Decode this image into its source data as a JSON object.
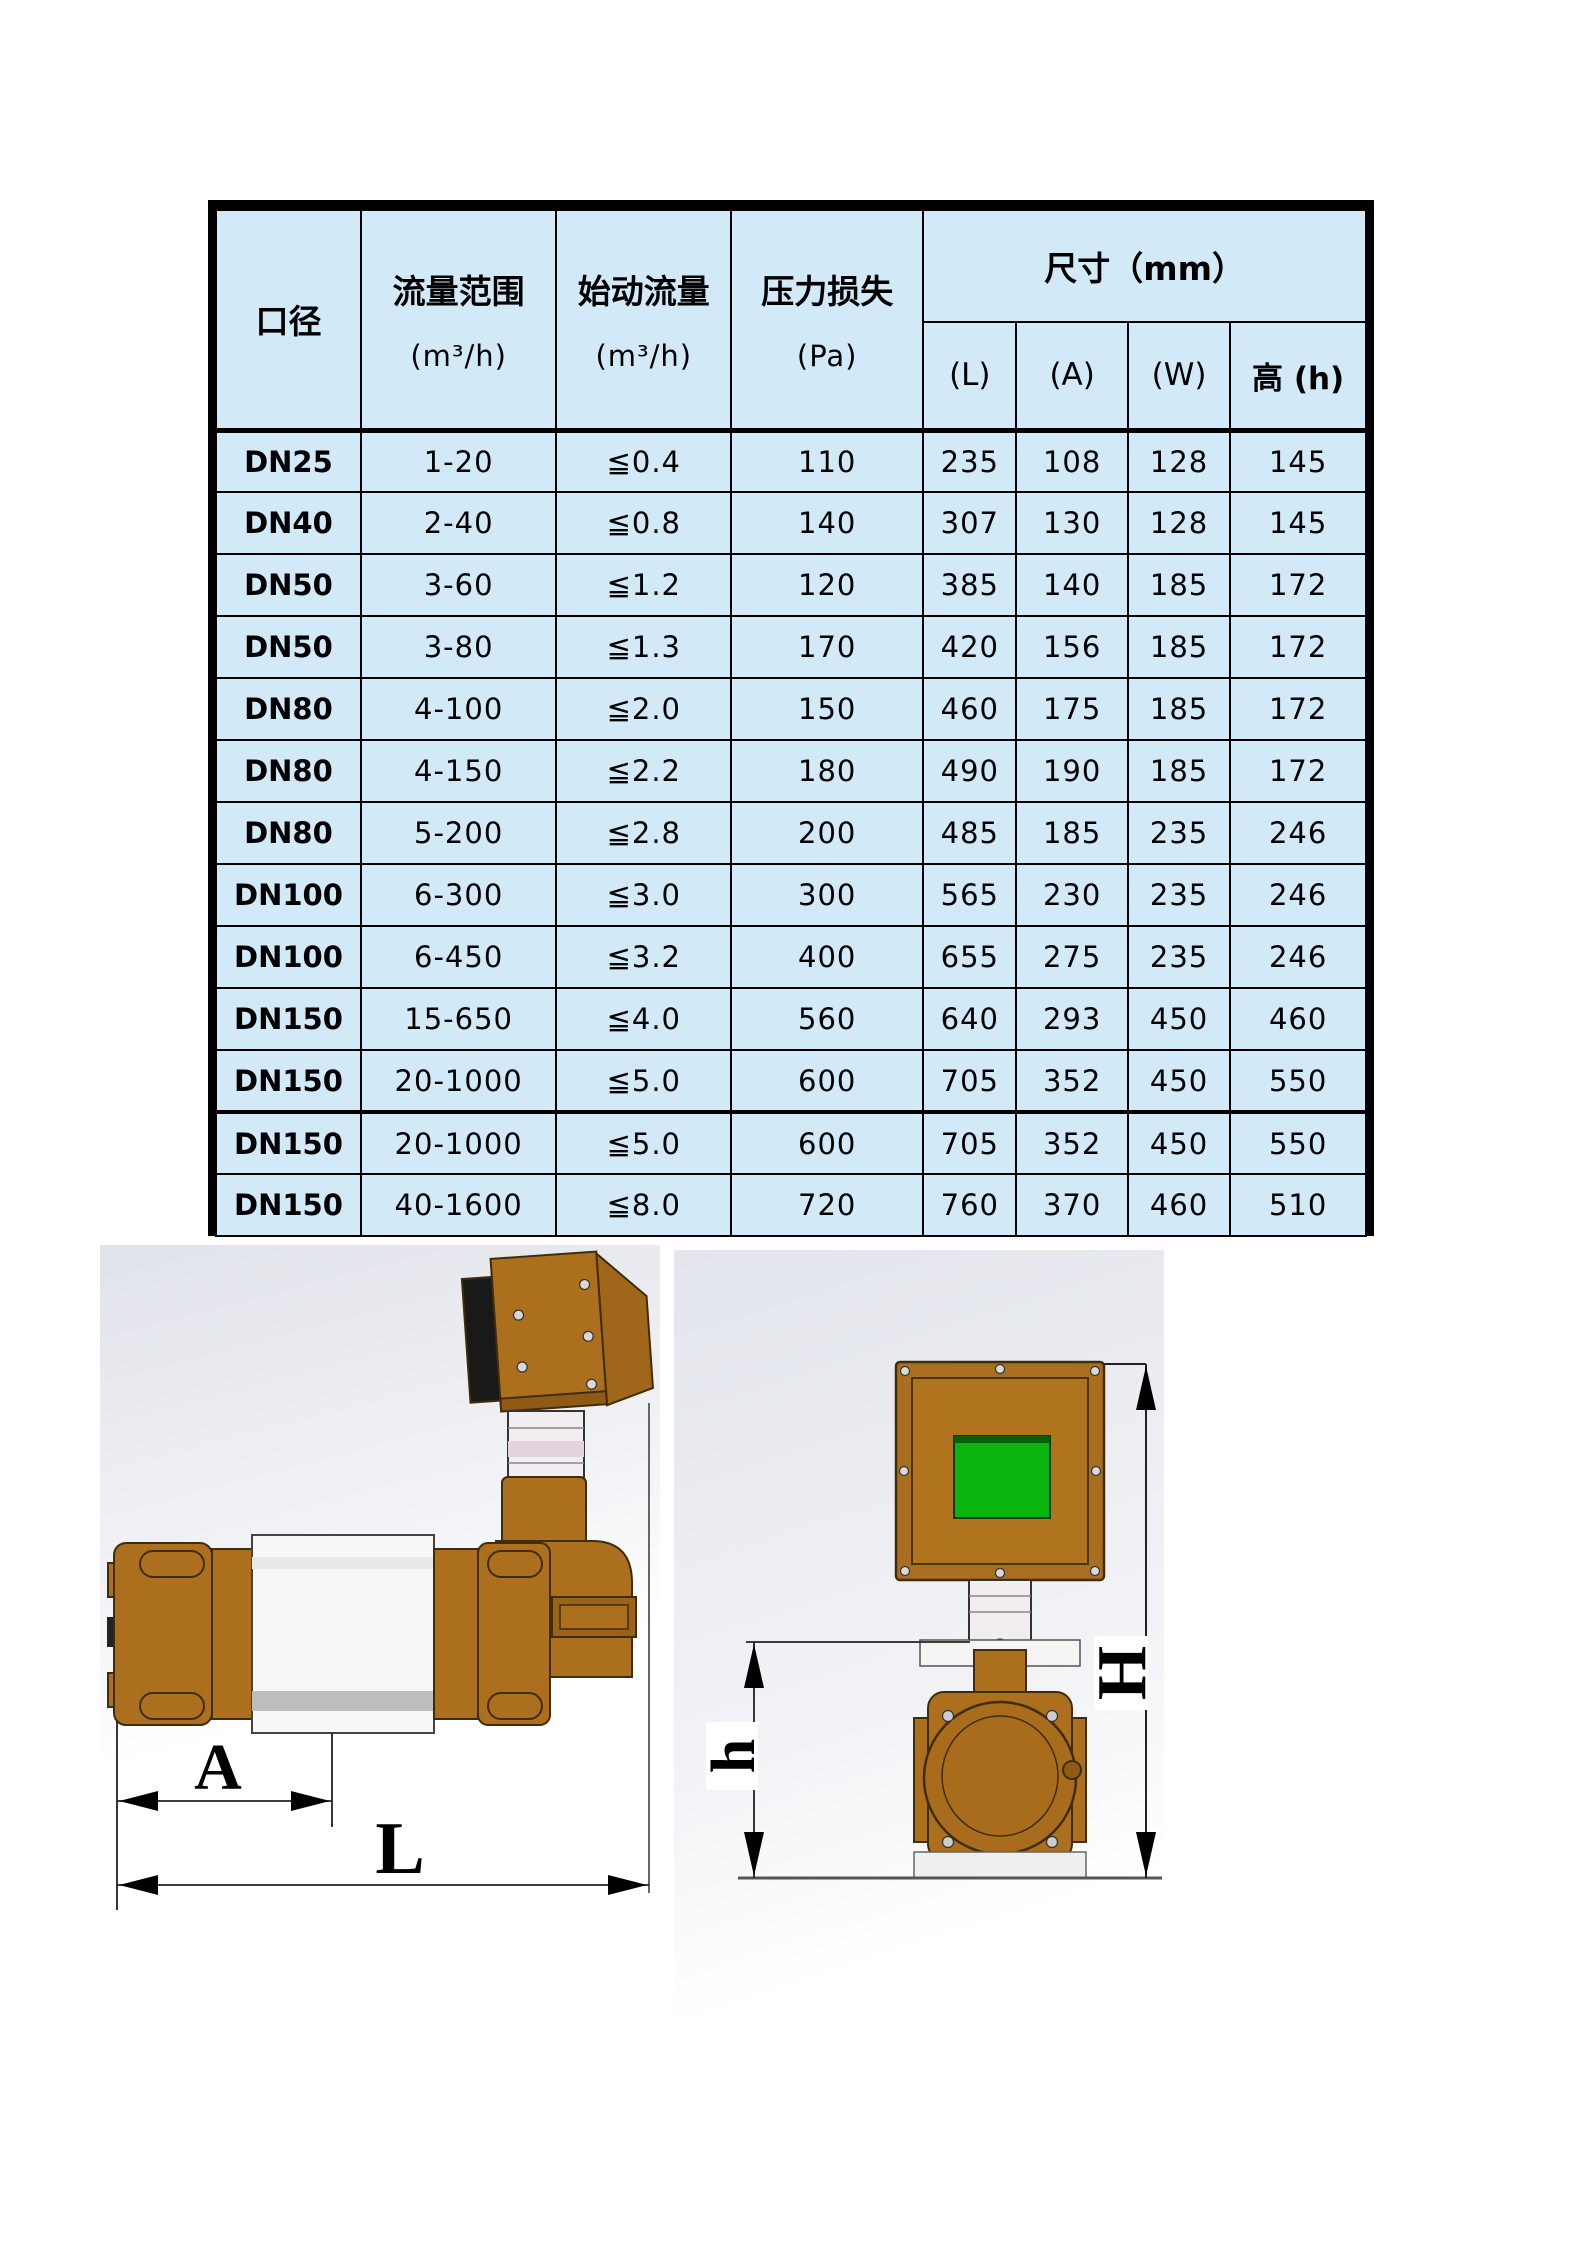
{
  "table": {
    "header": {
      "diameter": "口径",
      "flow_range": "流量范围",
      "flow_range_unit": "(m³/h)",
      "start_flow": "始动流量",
      "start_flow_unit": "(m³/h)",
      "pressure_loss": "压力损失",
      "pressure_loss_unit": "(Pa)",
      "dimensions": "尺寸（mm）",
      "dim_l": "(L)",
      "dim_a": "(A)",
      "dim_w": "(W)",
      "dim_h": "高 (h)"
    },
    "rows": [
      [
        "DN25",
        "1-20",
        "≦0.4",
        "110",
        "235",
        "108",
        "128",
        "145"
      ],
      [
        "DN40",
        "2-40",
        "≦0.8",
        "140",
        "307",
        "130",
        "128",
        "145"
      ],
      [
        "DN50",
        "3-60",
        "≦1.2",
        "120",
        "385",
        "140",
        "185",
        "172"
      ],
      [
        "DN50",
        "3-80",
        "≦1.3",
        "170",
        "420",
        "156",
        "185",
        "172"
      ],
      [
        "DN80",
        "4-100",
        "≦2.0",
        "150",
        "460",
        "175",
        "185",
        "172"
      ],
      [
        "DN80",
        "4-150",
        "≦2.2",
        "180",
        "490",
        "190",
        "185",
        "172"
      ],
      [
        "DN80",
        "5-200",
        "≦2.8",
        "200",
        "485",
        "185",
        "235",
        "246"
      ],
      [
        "DN100",
        "6-300",
        "≦3.0",
        "300",
        "565",
        "230",
        "235",
        "246"
      ],
      [
        "DN100",
        "6-450",
        "≦3.2",
        "400",
        "655",
        "275",
        "235",
        "246"
      ],
      [
        "DN150",
        "15-650",
        "≦4.0",
        "560",
        "640",
        "293",
        "450",
        "460"
      ],
      [
        "DN150",
        "20-1000",
        "≦5.0",
        "600",
        "705",
        "352",
        "450",
        "550"
      ],
      [
        "DN150",
        "20-1000",
        "≦5.0",
        "600",
        "705",
        "352",
        "450",
        "550"
      ],
      [
        "DN150",
        "40-1600",
        "≦8.0",
        "720",
        "760",
        "370",
        "460",
        "510"
      ]
    ],
    "colors": {
      "cell_bg": "#d2e9f8",
      "border": "#000000"
    }
  },
  "drawings": {
    "side_view": {
      "dim_a": "A",
      "dim_l": "L"
    },
    "front_view": {
      "dim_h": "h",
      "dim_height": "H",
      "screen_color": "#0ab40e"
    },
    "colors": {
      "brass": "#ab6f1e",
      "brass_dark": "#8f5a14",
      "outline": "#3f2d0a"
    }
  }
}
